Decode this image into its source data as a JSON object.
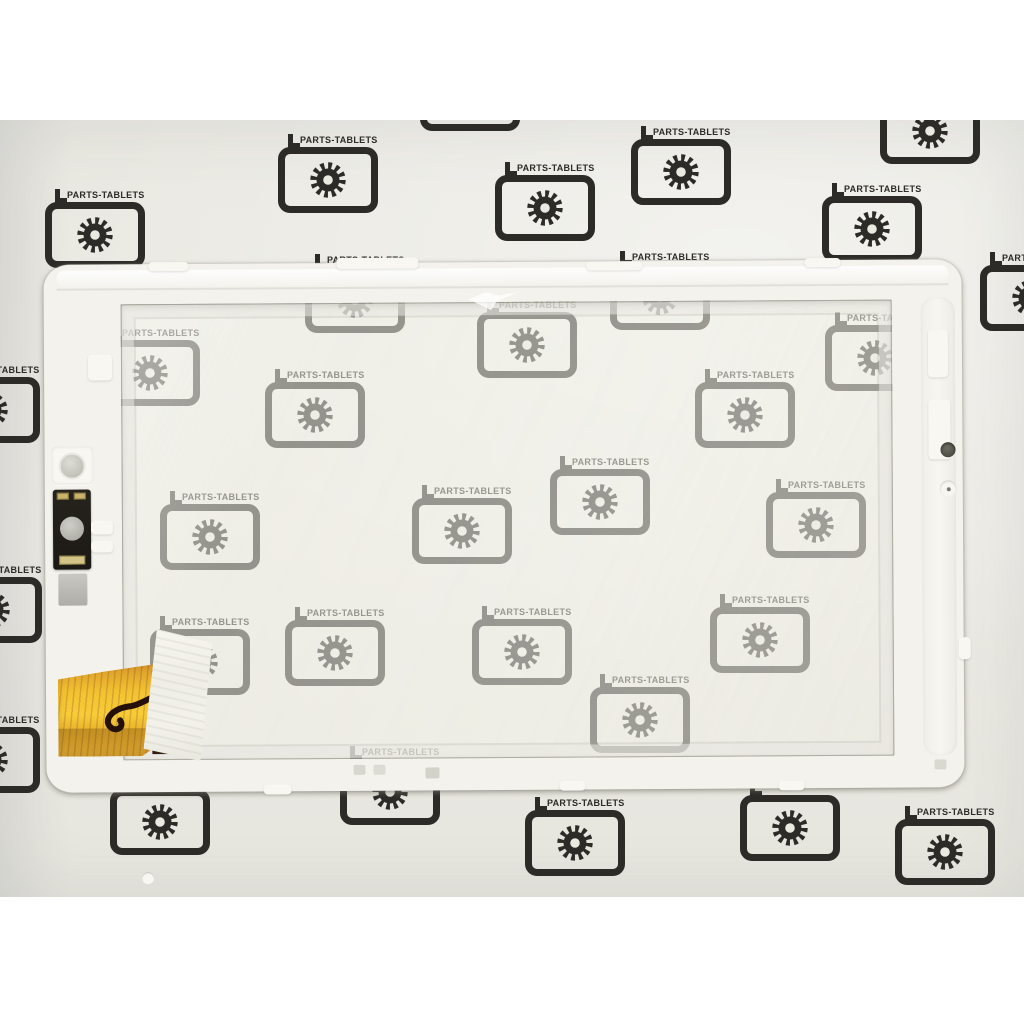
{
  "scene": {
    "description": "Product photo of a white tablet touchscreen digitizer frame with camera module and gold flex cable, lying on paper printed with a repeating watermark pattern; white borders above and below the photo",
    "canvas": {
      "width": 1024,
      "height": 1024
    }
  },
  "watermark": {
    "label": "PARTS-TABLETS",
    "icon": "tablet-with-gear-icon"
  },
  "colors": {
    "page_background": "#ffffff",
    "photo_background": "#eae9e2",
    "watermark_ink": "#2d2b27",
    "frame_plastic": "#f3f2ec",
    "glass_tint": "#f0efe6",
    "flex_cable_amber": "#f3c232",
    "flex_connector_brown": "#3f2718",
    "tape_white": "#f3f2ea",
    "camera_module_black": "#221f1a",
    "contact_pad_gold": "#c9b26b"
  },
  "watermarks": [
    {
      "cx": 470,
      "cy": -22,
      "label": false
    },
    {
      "cx": 930,
      "cy": 11,
      "label": false
    },
    {
      "cx": 95,
      "cy": 115,
      "label": true
    },
    {
      "cx": 328,
      "cy": 60,
      "label": true
    },
    {
      "cx": 545,
      "cy": 88,
      "label": true
    },
    {
      "cx": 681,
      "cy": 52,
      "label": true
    },
    {
      "cx": 872,
      "cy": 109,
      "label": true
    },
    {
      "cx": 1030,
      "cy": 178,
      "label": true
    },
    {
      "cx": -10,
      "cy": 290,
      "label": true
    },
    {
      "cx": -8,
      "cy": 490,
      "label": true
    },
    {
      "cx": -10,
      "cy": 640,
      "label": true
    },
    {
      "cx": 160,
      "cy": 702,
      "label": false
    },
    {
      "cx": 575,
      "cy": 723,
      "label": true
    },
    {
      "cx": 790,
      "cy": 708,
      "label": false
    },
    {
      "cx": 945,
      "cy": 732,
      "label": true
    },
    {
      "cx": 355,
      "cy": 180,
      "label": true
    },
    {
      "cx": 660,
      "cy": 177,
      "label": true
    },
    {
      "cx": 150,
      "cy": 253,
      "label": true
    },
    {
      "cx": 527,
      "cy": 225,
      "label": true
    },
    {
      "cx": 875,
      "cy": 238,
      "label": true
    },
    {
      "cx": 315,
      "cy": 295,
      "label": true
    },
    {
      "cx": 745,
      "cy": 295,
      "label": true
    },
    {
      "cx": 210,
      "cy": 417,
      "label": true
    },
    {
      "cx": 462,
      "cy": 411,
      "label": true
    },
    {
      "cx": 600,
      "cy": 382,
      "label": true
    },
    {
      "cx": 816,
      "cy": 405,
      "label": true
    },
    {
      "cx": 335,
      "cy": 533,
      "label": true
    },
    {
      "cx": 522,
      "cy": 532,
      "label": true
    },
    {
      "cx": 760,
      "cy": 520,
      "label": true
    },
    {
      "cx": 640,
      "cy": 600,
      "label": true
    },
    {
      "cx": 200,
      "cy": 542,
      "label": true
    },
    {
      "cx": 390,
      "cy": 672,
      "label": true
    }
  ]
}
